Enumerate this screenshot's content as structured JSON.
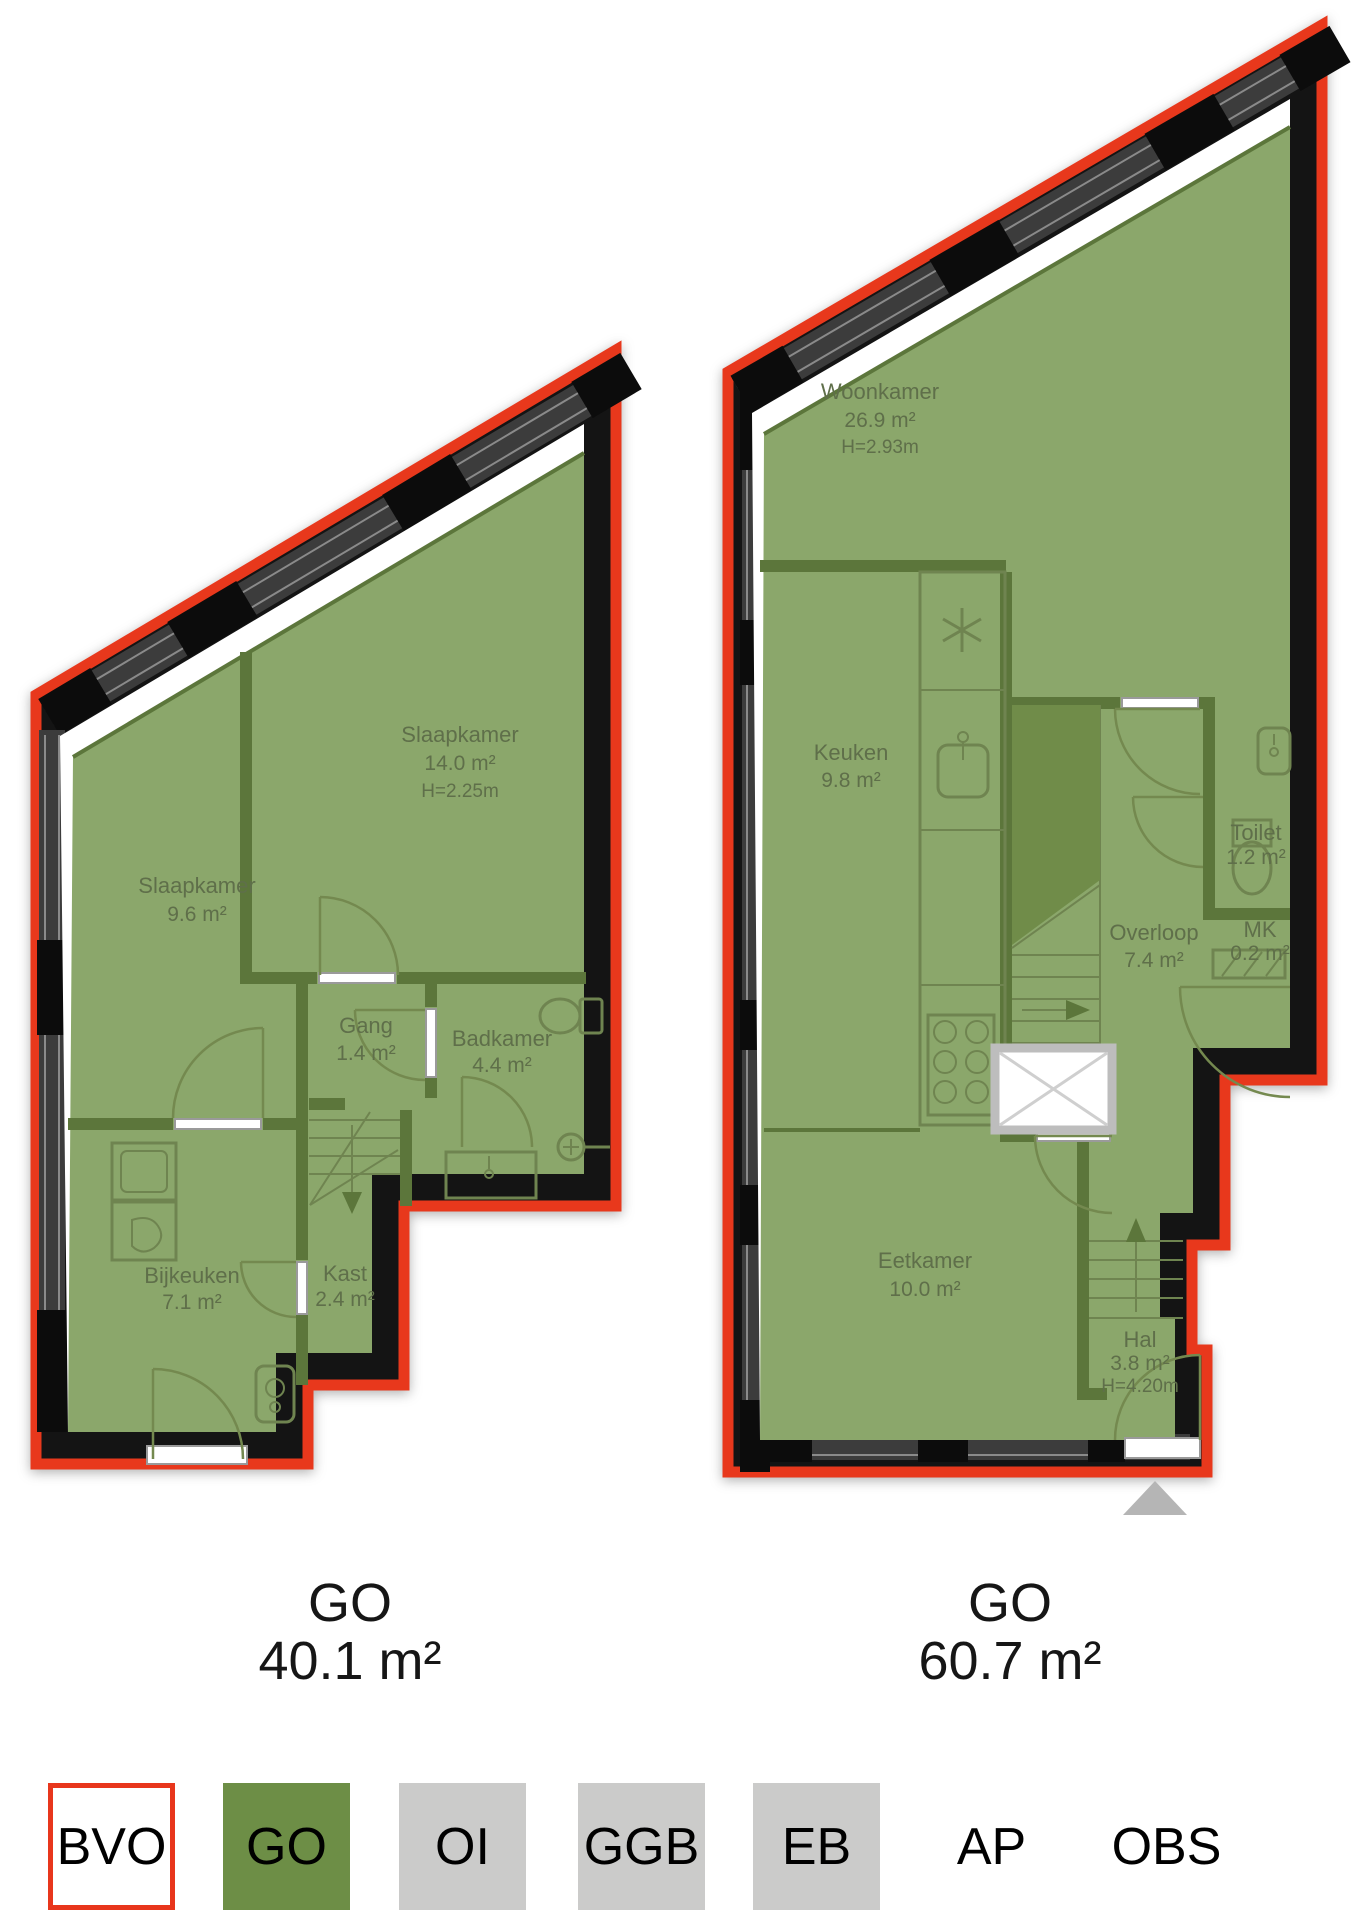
{
  "title": "Woning plattegrond (floor plan) met gebruiksoppervlakte",
  "colors": {
    "bvo_outline_red": "#e8381c",
    "wall_black": "#141414",
    "window_gray": "#3c3c3c",
    "floor_green_go": "#8ba76b",
    "interior_wall_green": "#5c763b",
    "legend_green": "#6d8e46",
    "legend_gray": "#cbcbca",
    "label_text": "#5f6f4a",
    "entrance_arrow_gray": "#b5b5b5"
  },
  "plans": {
    "left": {
      "go": {
        "label": "GO",
        "area": "40.1 m²"
      },
      "rooms": [
        {
          "name": "Slaapkamer",
          "area": "9.6 m²"
        },
        {
          "name": "Slaapkamer",
          "area": "14.0 m²",
          "height": "H=2.25m"
        },
        {
          "name": "Gang",
          "area": "1.4 m²"
        },
        {
          "name": "Badkamer",
          "area": "4.4 m²"
        },
        {
          "name": "Bijkeuken",
          "area": "7.1 m²"
        },
        {
          "name": "Kast",
          "area": "2.4 m²"
        }
      ]
    },
    "right": {
      "go": {
        "label": "GO",
        "area": "60.7 m²"
      },
      "rooms": [
        {
          "name": "Woonkamer",
          "area": "26.9 m²",
          "height": "H=2.93m"
        },
        {
          "name": "Keuken",
          "area": "9.8 m²"
        },
        {
          "name": "Overloop",
          "area": "7.4 m²"
        },
        {
          "name": "Toilet",
          "area": "1.2 m²"
        },
        {
          "name": "MK",
          "area": "0.2 m²"
        },
        {
          "name": "Eetkamer",
          "area": "10.0 m²"
        },
        {
          "name": "Hal",
          "area": "3.8 m²",
          "height": "H=4.20m"
        }
      ]
    }
  },
  "legend": {
    "items": [
      {
        "label": "BVO",
        "style": "outline-red"
      },
      {
        "label": "GO",
        "style": "green-fill"
      },
      {
        "label": "OI",
        "style": "gray-fill"
      },
      {
        "label": "GGB",
        "style": "gray-fill"
      },
      {
        "label": "EB",
        "style": "gray-fill"
      },
      {
        "label": "AP",
        "style": "text-only"
      },
      {
        "label": "OBS",
        "style": "text-only"
      }
    ]
  }
}
